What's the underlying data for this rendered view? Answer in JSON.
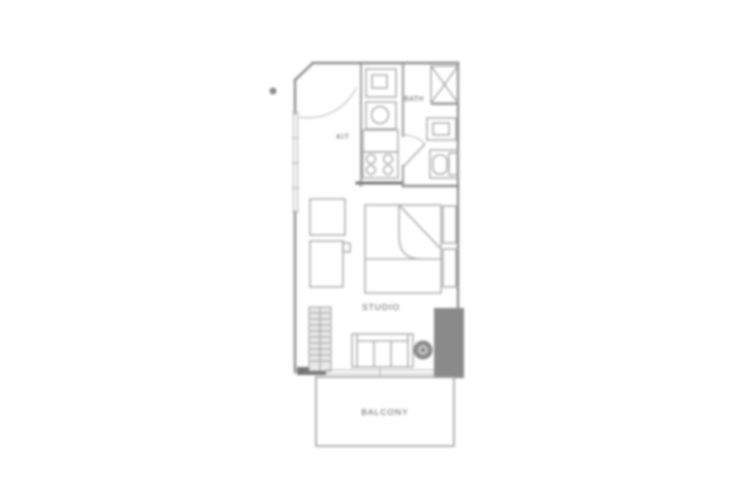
{
  "floorplan": {
    "rooms": {
      "kitchen": {
        "label": "KIT"
      },
      "bath": {
        "label": "BATH"
      },
      "studio": {
        "label": "STUDIO"
      },
      "balcony": {
        "label": "BALCONY"
      }
    },
    "colors": {
      "background": "#ffffff",
      "wall": "#8e8e8e",
      "wall_dark": "#767676",
      "wall_light": "#b3b3b3",
      "fixture": "#a0a0a0",
      "solid_block": "#8a8a8a",
      "label_text": "#5c5c5c"
    }
  }
}
